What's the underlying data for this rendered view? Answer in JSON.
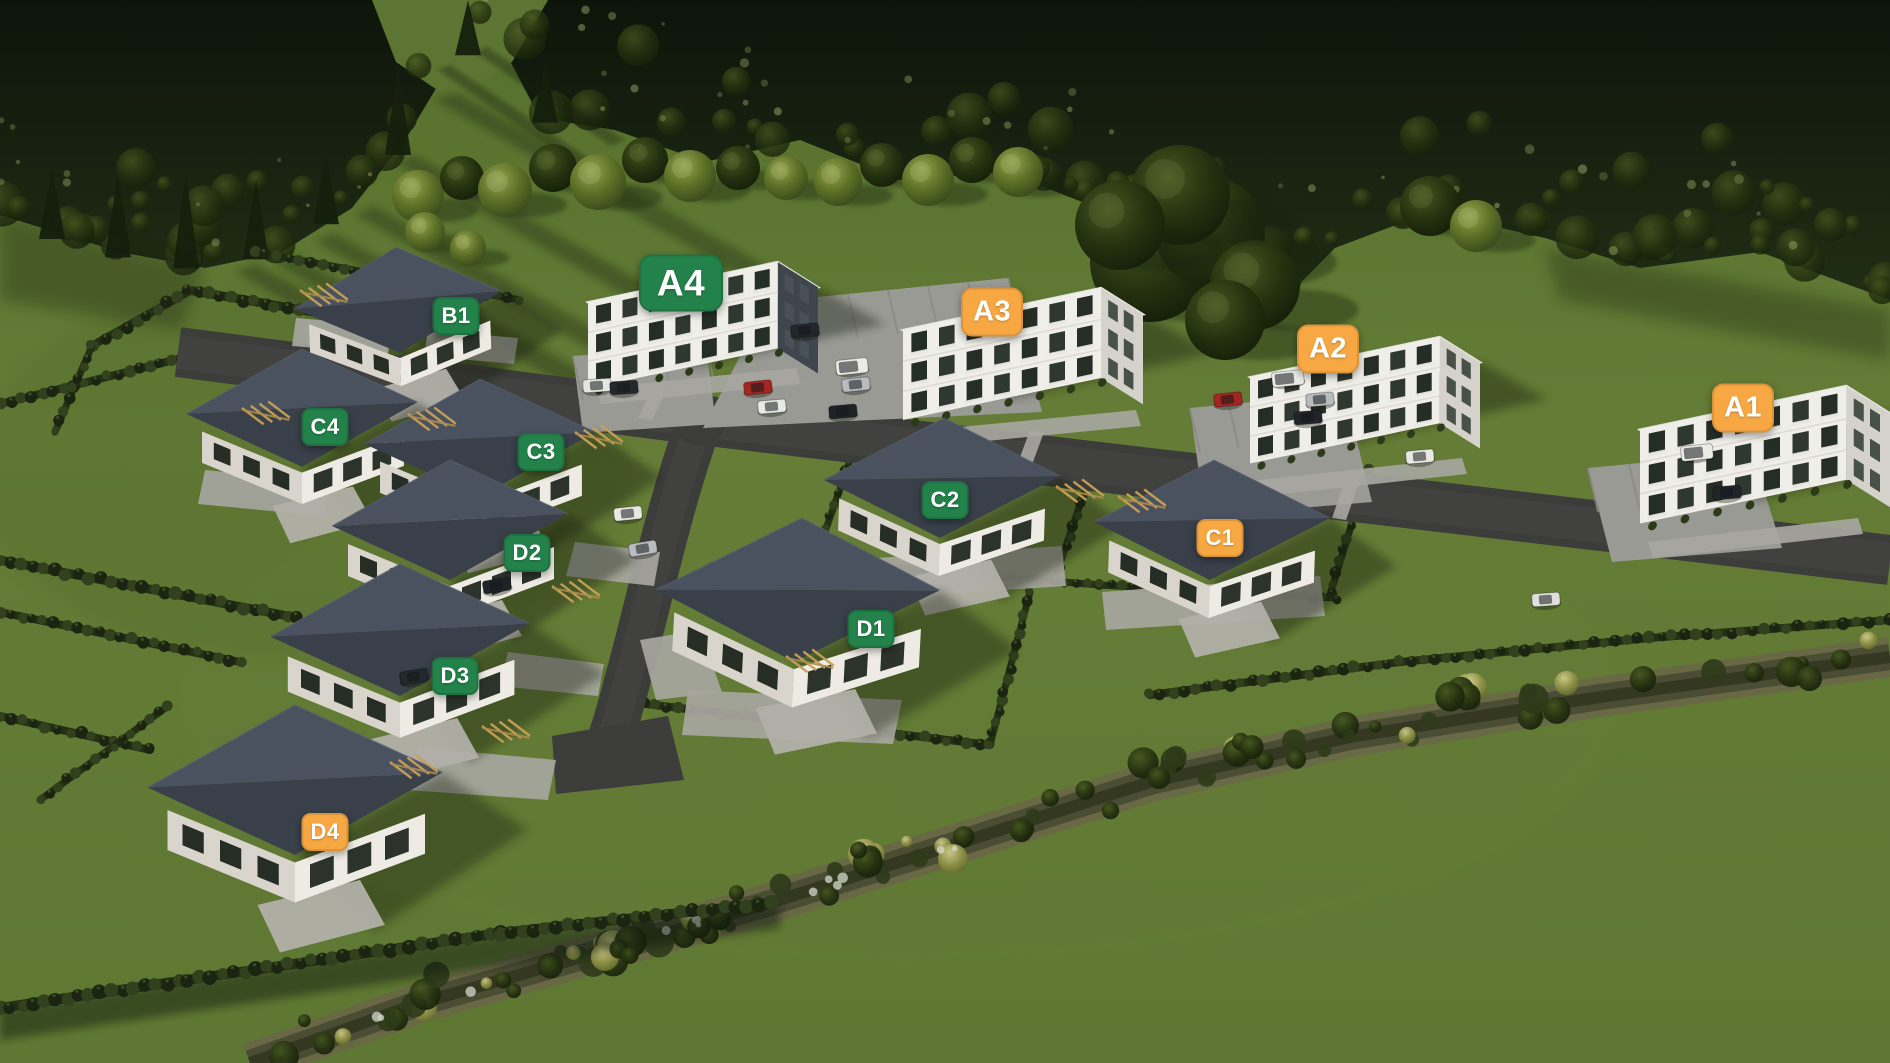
{
  "view": {
    "description": "Aerial 3D visualization of a housing estate with labeled buildings"
  },
  "badge_colors": {
    "green": "#23824a",
    "orange": "#f7a843"
  },
  "scene_colors": {
    "grass": "#617935",
    "forest": "#111a0c",
    "road_asphalt": "#3c3c3a",
    "parking_concrete": "#9a9a95",
    "house_roof": "#3a4049",
    "walls": "#eeebe4",
    "stream": "#4a4c34"
  },
  "buildings": [
    {
      "id": "A4",
      "label": "A4",
      "color": "green",
      "type": "apartment"
    },
    {
      "id": "A3",
      "label": "A3",
      "color": "orange",
      "type": "apartment"
    },
    {
      "id": "A2",
      "label": "A2",
      "color": "orange",
      "type": "apartment"
    },
    {
      "id": "A1",
      "label": "A1",
      "color": "orange",
      "type": "apartment"
    },
    {
      "id": "B1",
      "label": "B1",
      "color": "green",
      "type": "house"
    },
    {
      "id": "C4",
      "label": "C4",
      "color": "green",
      "type": "house"
    },
    {
      "id": "C3",
      "label": "C3",
      "color": "green",
      "type": "house"
    },
    {
      "id": "C2",
      "label": "C2",
      "color": "green",
      "type": "house"
    },
    {
      "id": "C1",
      "label": "C1",
      "color": "orange",
      "type": "house"
    },
    {
      "id": "D2",
      "label": "D2",
      "color": "green",
      "type": "house"
    },
    {
      "id": "D3",
      "label": "D3",
      "color": "green",
      "type": "house"
    },
    {
      "id": "D1",
      "label": "D1",
      "color": "green",
      "type": "house"
    },
    {
      "id": "D4",
      "label": "D4",
      "color": "orange",
      "type": "house"
    }
  ]
}
